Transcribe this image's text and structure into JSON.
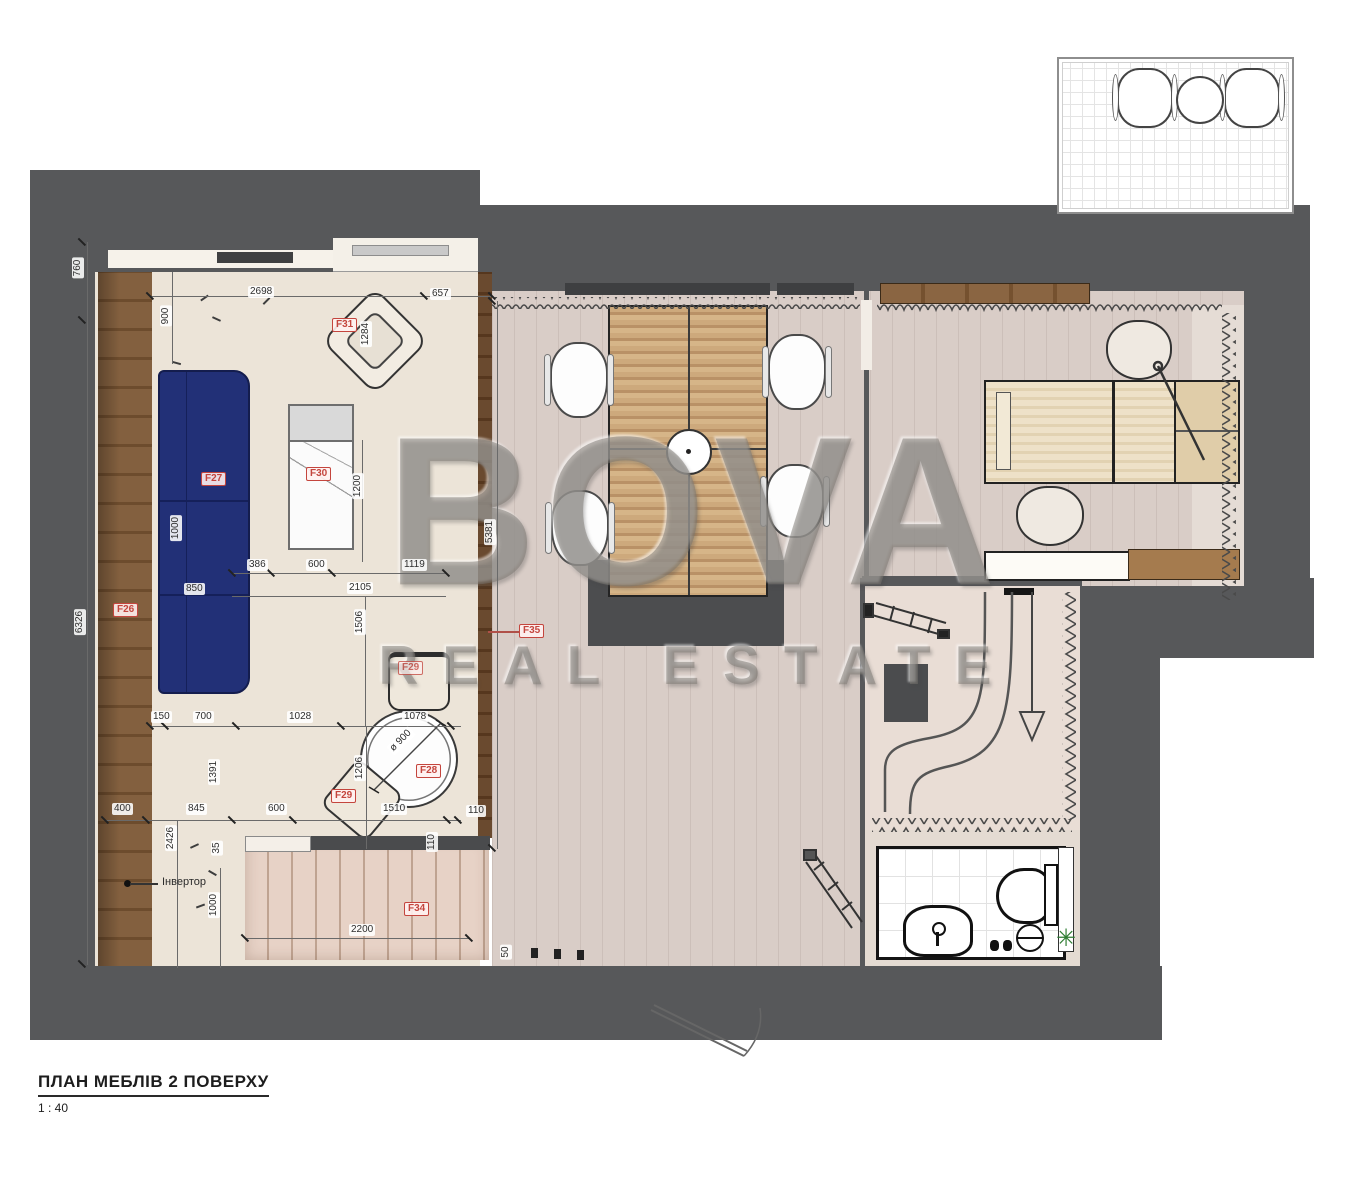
{
  "title": {
    "text": "ПЛАН МЕБЛІВ 2 ПОВЕРХУ",
    "scale": "1 : 40"
  },
  "watermark": {
    "line1": "BOVA",
    "line2": "REAL ESTATE"
  },
  "annotations": {
    "inverter": "Інвертор"
  },
  "furniture_labels": {
    "f26": "F26",
    "f27": "F27",
    "f28": "F28",
    "f29": "F29",
    "f29b": "F29",
    "f30": "F30",
    "f31": "F31",
    "f34": "F34",
    "f35": "F35"
  },
  "dimensions": {
    "d2698": "2698",
    "d657": "657",
    "d760": "760",
    "d6326": "6326",
    "d900": "900",
    "d1284": "1284",
    "d1200": "1200",
    "d1000a": "1000",
    "d850": "850",
    "d386": "386",
    "d600a": "600",
    "d1119": "1119",
    "d2105": "2105",
    "d1506": "1506",
    "d150": "150",
    "d700": "700",
    "d1028": "1028",
    "d1078": "1078",
    "d1206": "1206",
    "ddia900": "ø 900",
    "d1391": "1391",
    "d400": "400",
    "d845": "845",
    "d600b": "600",
    "d1510": "1510",
    "d110a": "110",
    "d110b": "110",
    "d2426": "2426",
    "d35": "35",
    "d1000b": "1000",
    "d2200": "2200",
    "d5381": "5381",
    "d50": "50"
  },
  "icons": {
    "plant": "✳"
  },
  "colors": {
    "wall": "#57585a",
    "sofa_blue": "#223077",
    "label_red": "#c4453d",
    "wood_wall": "#7c5a3b",
    "table_wood": "#c9a577",
    "floor_living": "#ece4d8",
    "floor_hall": "#d9cdc7",
    "floor_void": "#e9ddd5",
    "rug_dark": "#4c4d4f",
    "watermark_gray": "#9a9692"
  }
}
